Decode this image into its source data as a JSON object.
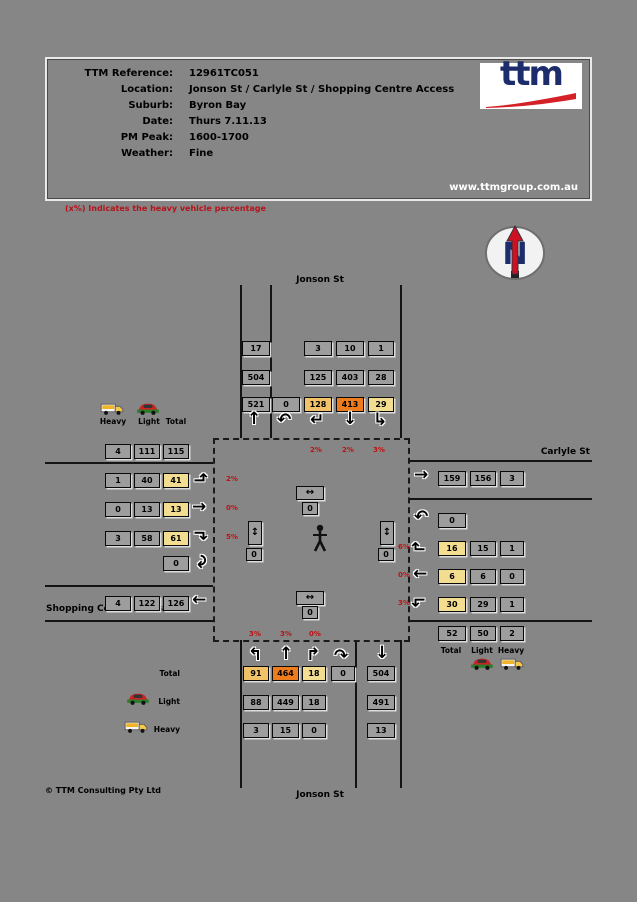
{
  "header": {
    "rows": [
      {
        "label": "TTM Reference:",
        "value": "12961TC051"
      },
      {
        "label": "Location:",
        "value": "Jonson St / Carlyle St / Shopping Centre Access"
      },
      {
        "label": "Suburb:",
        "value": "Byron Bay"
      },
      {
        "label": "Date:",
        "value": "Thurs 7.11.13"
      },
      {
        "label": "PM Peak:",
        "value": "1600-1700"
      },
      {
        "label": "Weather:",
        "value": "Fine"
      }
    ],
    "logo_text": "ttm",
    "website": "www.ttmgroup.com.au"
  },
  "note": "(x%) Indicates the heavy vehicle percentage",
  "compass_letter": "N",
  "streets": {
    "north": "Jonson St",
    "east": "Carlyle St",
    "west": "Shopping Centre Access",
    "south": "Jonson St"
  },
  "legend": {
    "heavy": "Heavy",
    "light": "Light",
    "total": "Total"
  },
  "north_arm": {
    "exit": {
      "heavy": "17",
      "light": "504",
      "total": "521"
    },
    "uturn": "0",
    "left": {
      "heavy": "3",
      "light": "125",
      "total": "128",
      "pct": "2%"
    },
    "through": {
      "heavy": "10",
      "light": "403",
      "total": "413",
      "pct": "2%"
    },
    "right": {
      "heavy": "1",
      "light": "28",
      "total": "29",
      "pct": "3%"
    }
  },
  "west_arm": {
    "approach_total": {
      "heavy": "4",
      "light": "111",
      "total": "115"
    },
    "left": {
      "heavy": "1",
      "light": "40",
      "total": "41",
      "pct": "2%"
    },
    "through": {
      "heavy": "0",
      "light": "13",
      "total": "13",
      "pct": "0%"
    },
    "right": {
      "heavy": "3",
      "light": "58",
      "total": "61",
      "pct": "5%"
    },
    "uturn": "0",
    "exit": {
      "heavy": "4",
      "light": "122",
      "total": "126"
    }
  },
  "east_arm": {
    "exit": {
      "total": "159",
      "light": "156",
      "heavy": "3"
    },
    "uturn": "0",
    "right": {
      "total": "16",
      "light": "15",
      "heavy": "1",
      "pct": "6%"
    },
    "through": {
      "total": "6",
      "light": "6",
      "heavy": "0",
      "pct": "0%"
    },
    "left": {
      "total": "30",
      "light": "29",
      "heavy": "1",
      "pct": "3%"
    },
    "approach_total": {
      "total": "52",
      "light": "50",
      "heavy": "2"
    }
  },
  "south_arm": {
    "left": {
      "total": "91",
      "light": "88",
      "heavy": "3",
      "pct": "3%"
    },
    "through": {
      "total": "464",
      "light": "449",
      "heavy": "15",
      "pct": "3%"
    },
    "right": {
      "total": "18",
      "light": "18",
      "heavy": "0",
      "pct": "0%"
    },
    "uturn": "0",
    "exit": {
      "total": "504",
      "light": "491",
      "heavy": "13"
    }
  },
  "pedestrians": {
    "north": "0",
    "west": "0",
    "east": "0",
    "south": "0"
  },
  "footer": "© TTM Consulting Pty Ltd"
}
